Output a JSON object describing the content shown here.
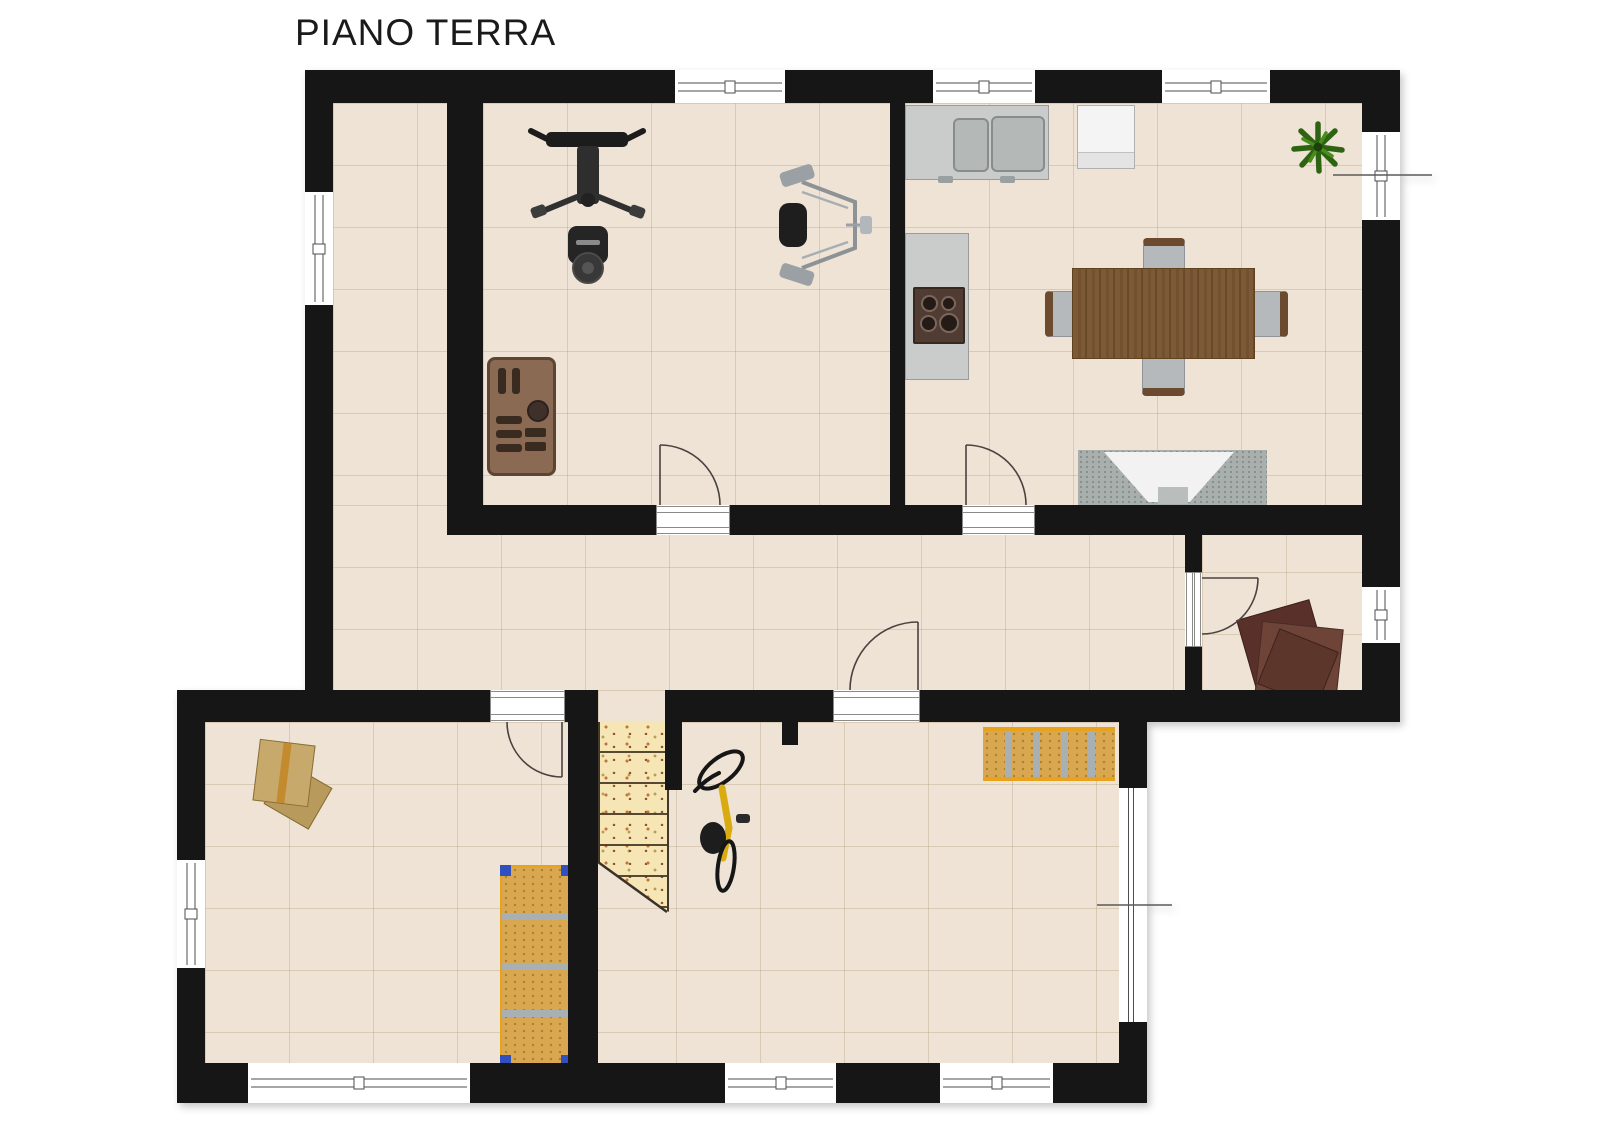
{
  "title": "PIANO TERRA",
  "plan": {
    "floor_label": "PIANO TERRA",
    "rooms": [
      "gym-room-top-left",
      "kitchen-dining-room-top-right",
      "l-shaped-hallway",
      "storage-room-mid-right",
      "room-bottom-left",
      "garage-room-bottom-right-with-stairs"
    ],
    "furniture": [
      "multi-gym machine",
      "pec-deck machine",
      "dumbbell rack",
      "kitchen counter with double sink",
      "white appliance",
      "stove on counter",
      "dining table with four chairs",
      "tv on rug",
      "potted plant",
      "stacked cardboard boxes",
      "vertical storage shelf",
      "wall storage shelf",
      "bicycle",
      "stacked wood boards",
      "staircase"
    ]
  },
  "colors": {
    "title": "#1a1a1a",
    "wall": "#161616",
    "floor": "#eee3d4",
    "floor_line": "rgba(190,170,145,0.45)",
    "window_line": "#4e4e4e",
    "stairs": "#f6e6b5",
    "counter": "#cacccb",
    "counter_border": "#9b9b9b",
    "sink": "#b4b8b7",
    "appliance": "#f4f4f4",
    "stove": "#503c33",
    "table_wood": "#7a5633",
    "chair_seat": "#b6b9bc",
    "chair_wood": "#6b4a2f",
    "rug": "#a9afad",
    "tv": "#f1f2f1",
    "plant_dark": "#2e6312",
    "plant_light": "#4b8c1e",
    "shelf": "#d8a750",
    "shelf_trim": "#e8a21c",
    "shelf_divider": "#a8b0b3",
    "shelf_corner": "#3050c0",
    "box": "#c7a96c",
    "wood_pile": "#5a312a",
    "rack": "#8a6a52",
    "bike_frame": "#d9ab10",
    "arc": "#4a4240",
    "dim": "#5a5a5a"
  }
}
